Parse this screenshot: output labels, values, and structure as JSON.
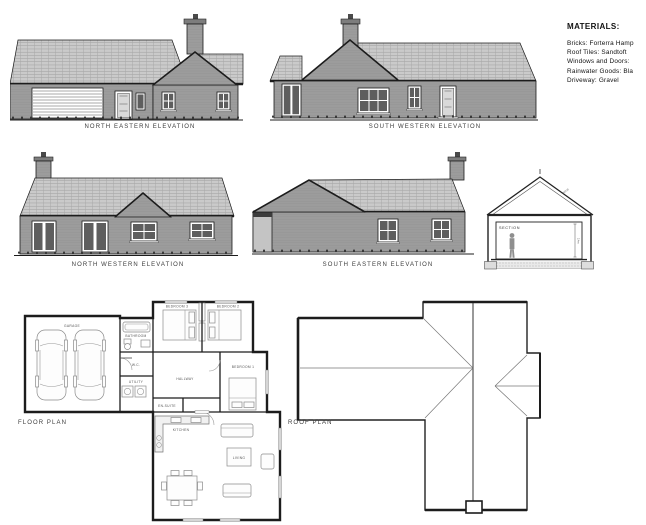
{
  "colors": {
    "paper": "#ffffff",
    "ink": "#1c1c1c",
    "wall_gray": "#9c9c9c",
    "roof_gray": "#cacaca",
    "label": "#3c3c3c"
  },
  "materials": {
    "title": "MATERIALS:",
    "lines": [
      "Bricks: Forterra Hamp",
      "Roof Tiles: Sandtoft",
      "Windows and Doors:",
      "Rainwater Goods: Bla",
      "Driveway: Gravel"
    ]
  },
  "labels": {
    "ne": "NORTH EASTERN ELEVATION",
    "sw": "SOUTH WESTERN ELEVATION",
    "nw": "NORTH WESTERN ELEVATION",
    "se": "SOUTH EASTERN ELEVATION",
    "floor": "FLOOR PLAN",
    "roof": "ROOF PLAN"
  },
  "section": {
    "label": "SECTION",
    "ridge_note": "RIDGE",
    "height_dim": "2.4m"
  },
  "floor_plan_rooms": {
    "garage": "GARAGE",
    "bedroom1": "BEDROOM 1",
    "bedroom2": "BEDROOM 2",
    "bedroom3": "BEDROOM 3",
    "bathroom": "BATHROOM",
    "wc": "W.C.",
    "utility": "UTILITY",
    "hallway": "HALLWAY",
    "ensuite": "EN-SUITE",
    "kitchen": "KITCHEN",
    "living": "LIVING"
  }
}
